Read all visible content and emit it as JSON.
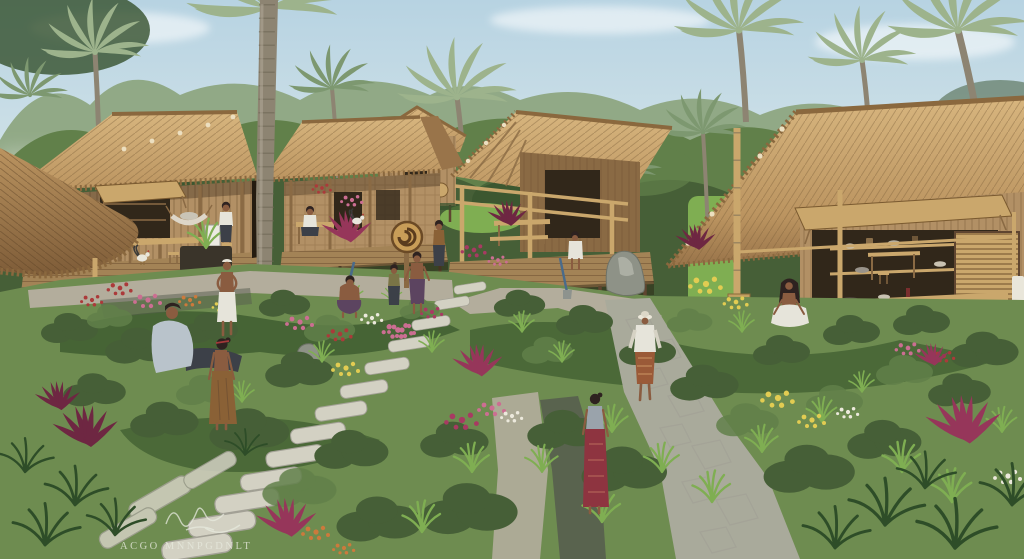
{
  "scene": {
    "alt": "Architectural illustration of a tropical village: six thatched-roof bamboo huts around lush flower gardens, stepping-stone and gravel paths, tall coconut palms over a dense green canopy, and villagers walking, sitting and working on porches.",
    "watermark": {
      "text": "ACGO MNNPGDNLT",
      "signature": "illegible cursive flourish"
    },
    "inventory": {
      "huts": 6,
      "people": 14,
      "roosters": 2,
      "palm_crowns": 10,
      "stepping_stone_runs": 2,
      "garden_ornament": "spiral disc on post"
    }
  },
  "palette": {
    "sky_top": "#b7d3e2",
    "sky_mid": "#d6e5e9",
    "sky_low": "#eaf0ec",
    "canopy_back": "#8ba37b",
    "canopy_mid": "#61804a",
    "canopy_front": "#465f37",
    "canopy_dark": "#35502c",
    "palm": "#9db38c",
    "palm_dark": "#7d9870",
    "trunk": "#8d8472",
    "trunk_dark": "#6e6654",
    "thatch_light": "#d7b57e",
    "thatch_mid": "#bb9460",
    "thatch_dark": "#99744a",
    "thatch_shadow": "#7e5c38",
    "thatch_edge": "#8a683e",
    "wood_light": "#caa76c",
    "wood_mid": "#b29065",
    "wood_dark": "#8a6a44",
    "wood_deep": "#5f4530",
    "opening": "#31271a",
    "deck": "#a38356",
    "deck_dark": "#7c5f3c",
    "gravel": "#b3ad9c",
    "stone": "#d3d1c3",
    "stone_shadow": "#a3a196",
    "flag": "#a9aa9b",
    "wet": "#565c4e",
    "grass": "#6e8c50",
    "grass_bright": "#7fae52",
    "bed": "#3c5a2e",
    "fern": "#2e4d28",
    "cordyline": "#96365a",
    "cordyline_dark": "#6e2742",
    "fl_pink": "#cc6e92",
    "fl_magenta": "#a83a62",
    "fl_red": "#ab3a3a",
    "fl_yellow": "#e2cc52",
    "fl_orange": "#cc7a3c",
    "fl_white": "#ece9dc",
    "skin": "#8a5c40",
    "hair": "#2e2220",
    "cloth_white": "#e6e4da",
    "cloth_grey": "#9aa3ab",
    "cloth_blue": "#b9c3cb",
    "cloth_red": "#8e3440",
    "cloth_purple": "#5c4460",
    "cloth_brown": "#8a6136",
    "cloth_olive": "#7a7446",
    "cloth_dark": "#3c4048",
    "watermark": "#e7e9dd"
  }
}
